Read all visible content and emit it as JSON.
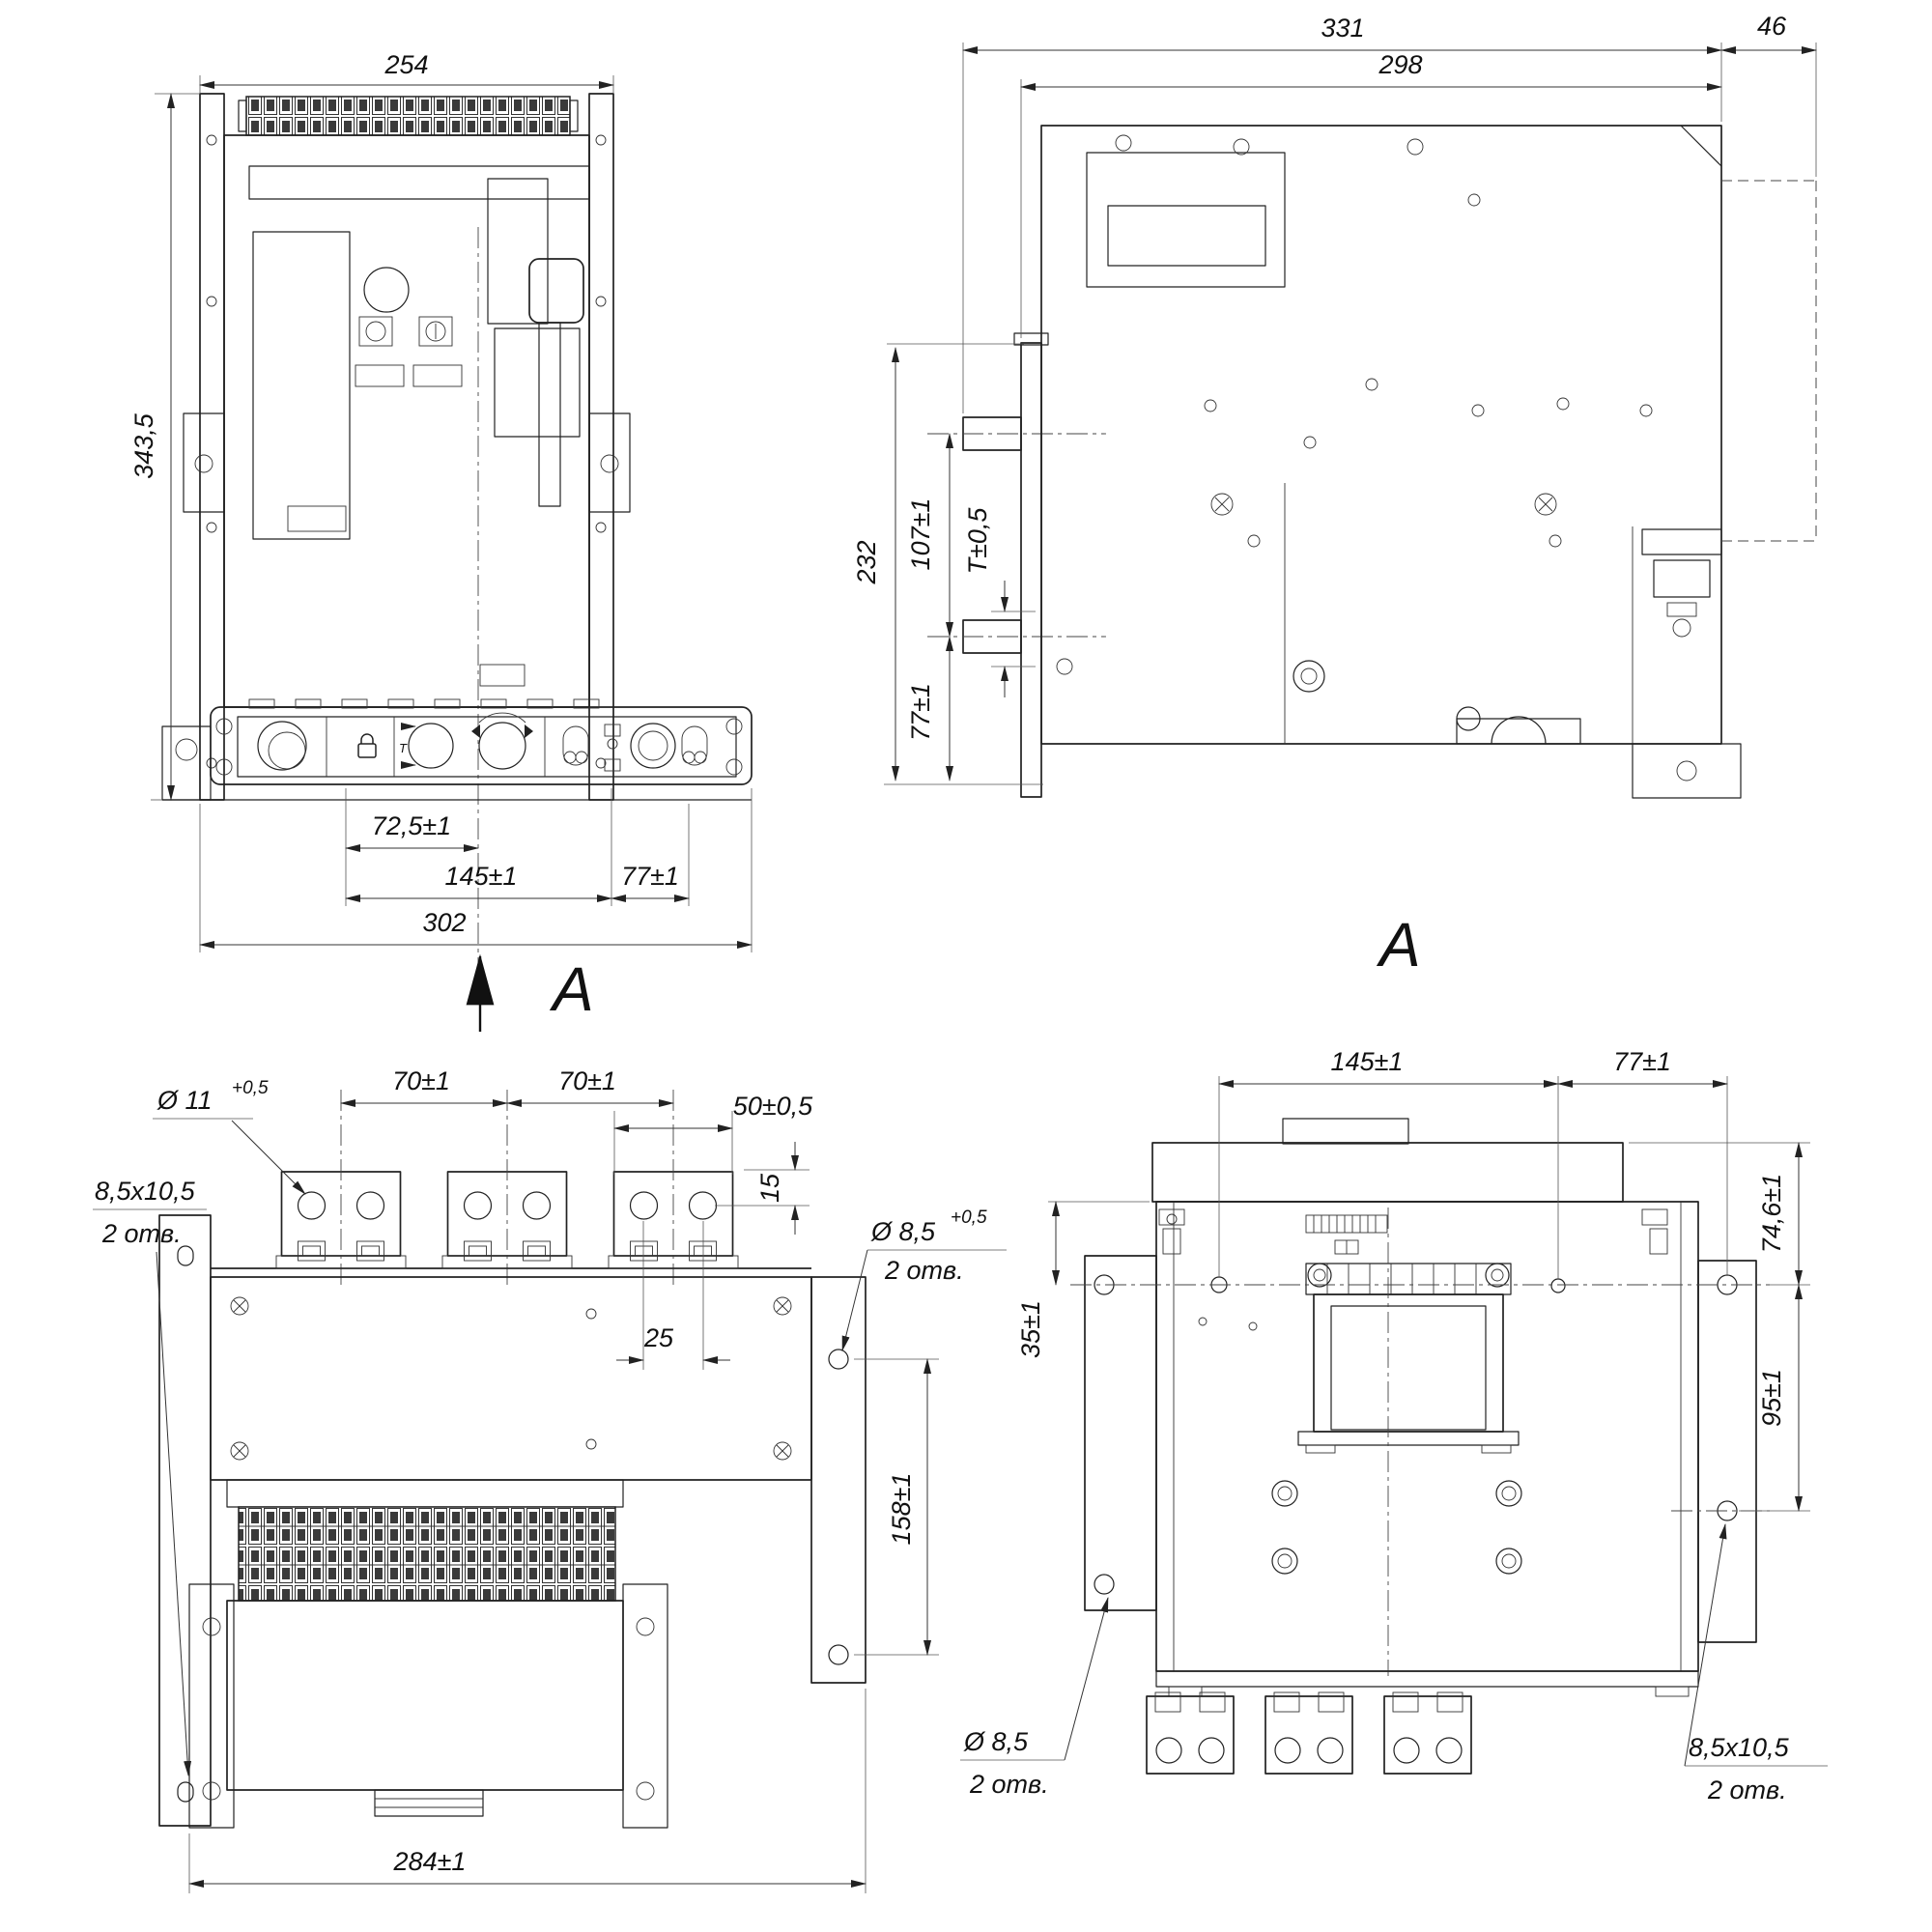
{
  "drawing": {
    "front": {
      "view_label": "A",
      "w": "254",
      "h": "343,5",
      "d_half": "72,5±1",
      "d_mid": "145±1",
      "d_right": "77±1",
      "d_total": "302",
      "panel_t": "T"
    },
    "side": {
      "view_label": "A",
      "d_total": "331",
      "d_body": "298",
      "d_rail": "46",
      "d_height": "232",
      "d_shaft": "107±1",
      "d_t": "T±0,5",
      "d_lower": "77±1"
    },
    "top": {
      "hole": "Ø 11",
      "hole_tol": "+0,5",
      "slot": "8,5x10,5",
      "slot_note": "2 отв.",
      "pitch1": "70±1",
      "pitch2": "70±1",
      "pad_w": "50±0,5",
      "edge": "15",
      "hole_cc": "25",
      "hole2": "Ø 8,5",
      "hole2_tol": "+0,5",
      "hole2_note": "2 отв.",
      "span_v": "158±1",
      "w_total": "284±1"
    },
    "bottom": {
      "d_left": "145±1",
      "d_right": "77±1",
      "d_top_r": "74,6±1",
      "d_left_v": "35±1",
      "d_right_v": "95±1",
      "hole": "Ø 8,5",
      "hole_note": "2 отв.",
      "slot": "8,5x10,5",
      "slot_note": "2 отв."
    }
  }
}
